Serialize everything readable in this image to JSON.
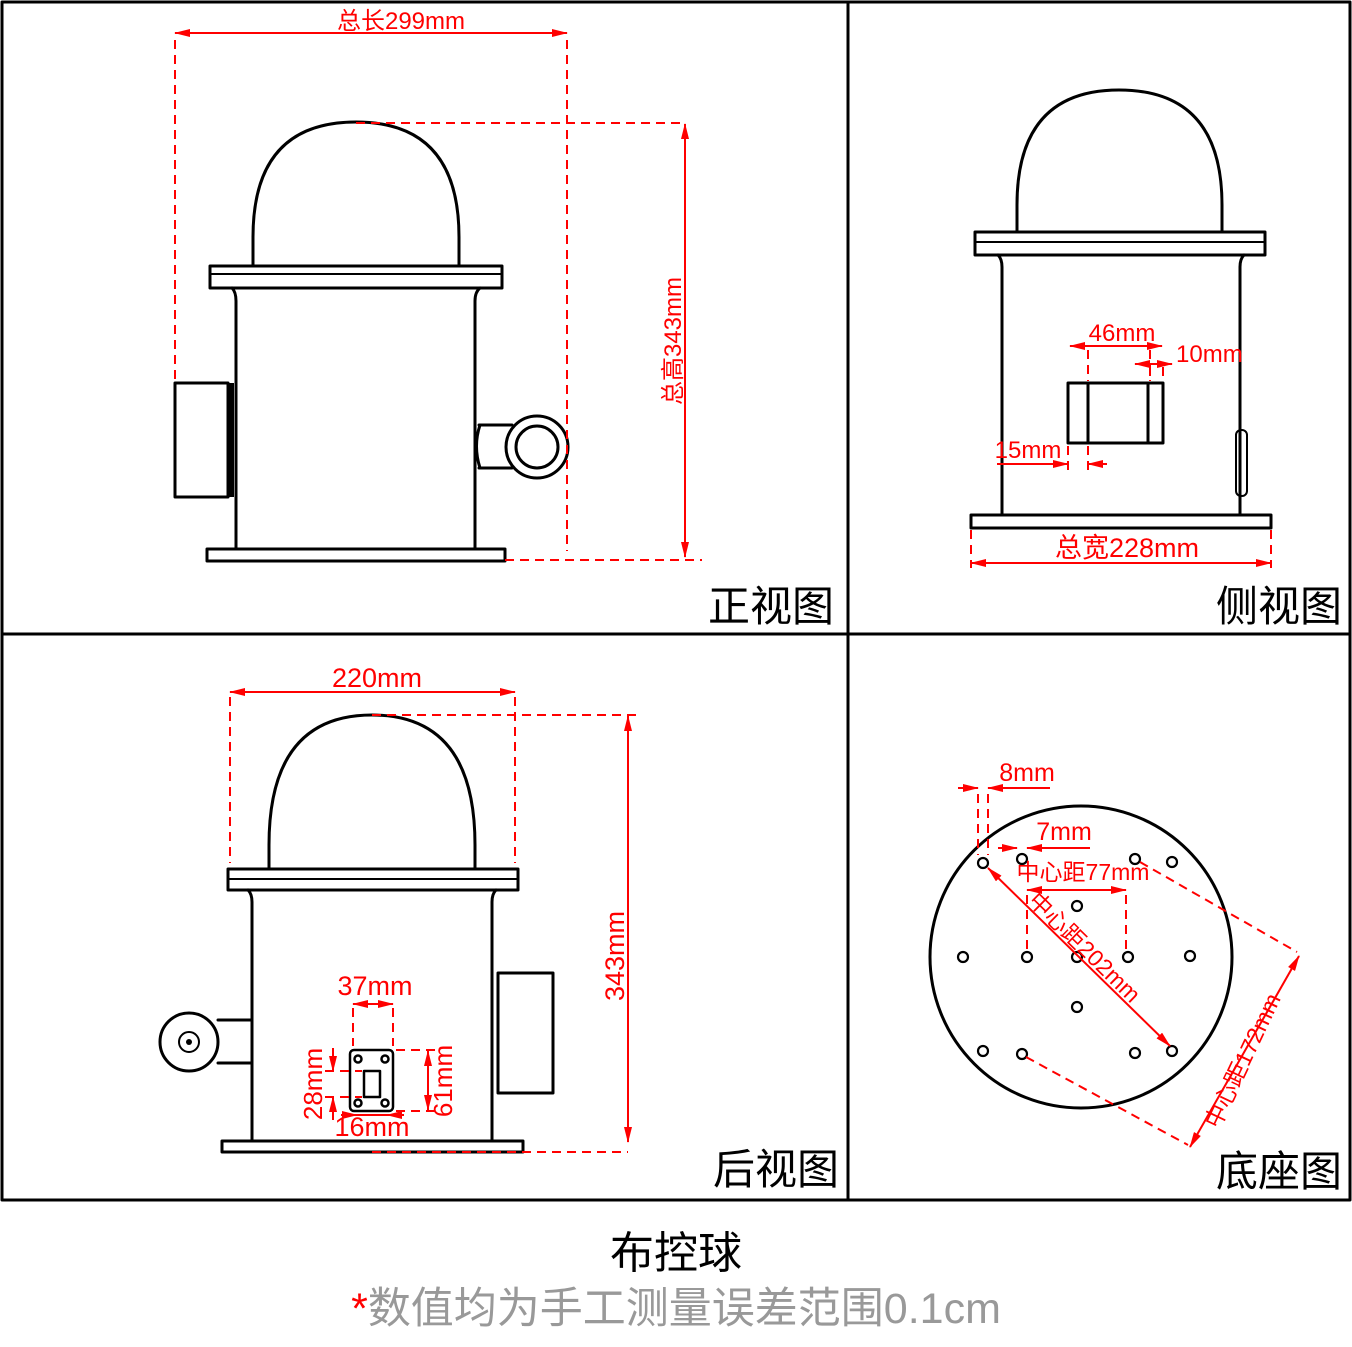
{
  "colors": {
    "outline": "#000000",
    "dimension": "#ff0000",
    "note_text": "#999999",
    "background": "#ffffff"
  },
  "views": {
    "front": {
      "label": "正视图",
      "dim_total_length": "总长299mm",
      "dim_total_height": "总高343mm"
    },
    "side": {
      "label": "侧视图",
      "dim_width": "46mm",
      "dim_offset_right": "10mm",
      "dim_offset_left": "15mm",
      "dim_total_width": "总宽228mm"
    },
    "rear": {
      "label": "后视图",
      "dim_dome_width": "220mm",
      "dim_height": "343mm",
      "dim_plate_width": "37mm",
      "dim_slot_height": "28mm",
      "dim_plate_height": "61mm",
      "dim_hole_span": "16mm"
    },
    "base": {
      "label": "底座图",
      "dim_hole_large": "8mm",
      "dim_hole_small": "7mm",
      "dim_center_77": "中心距77mm",
      "dim_center_202": "中心距202mm",
      "dim_center_172": "中心距172mm"
    }
  },
  "caption": {
    "title": "布控球",
    "note_mark": "*",
    "note": "数值均为手工测量误差范围0.1cm"
  }
}
